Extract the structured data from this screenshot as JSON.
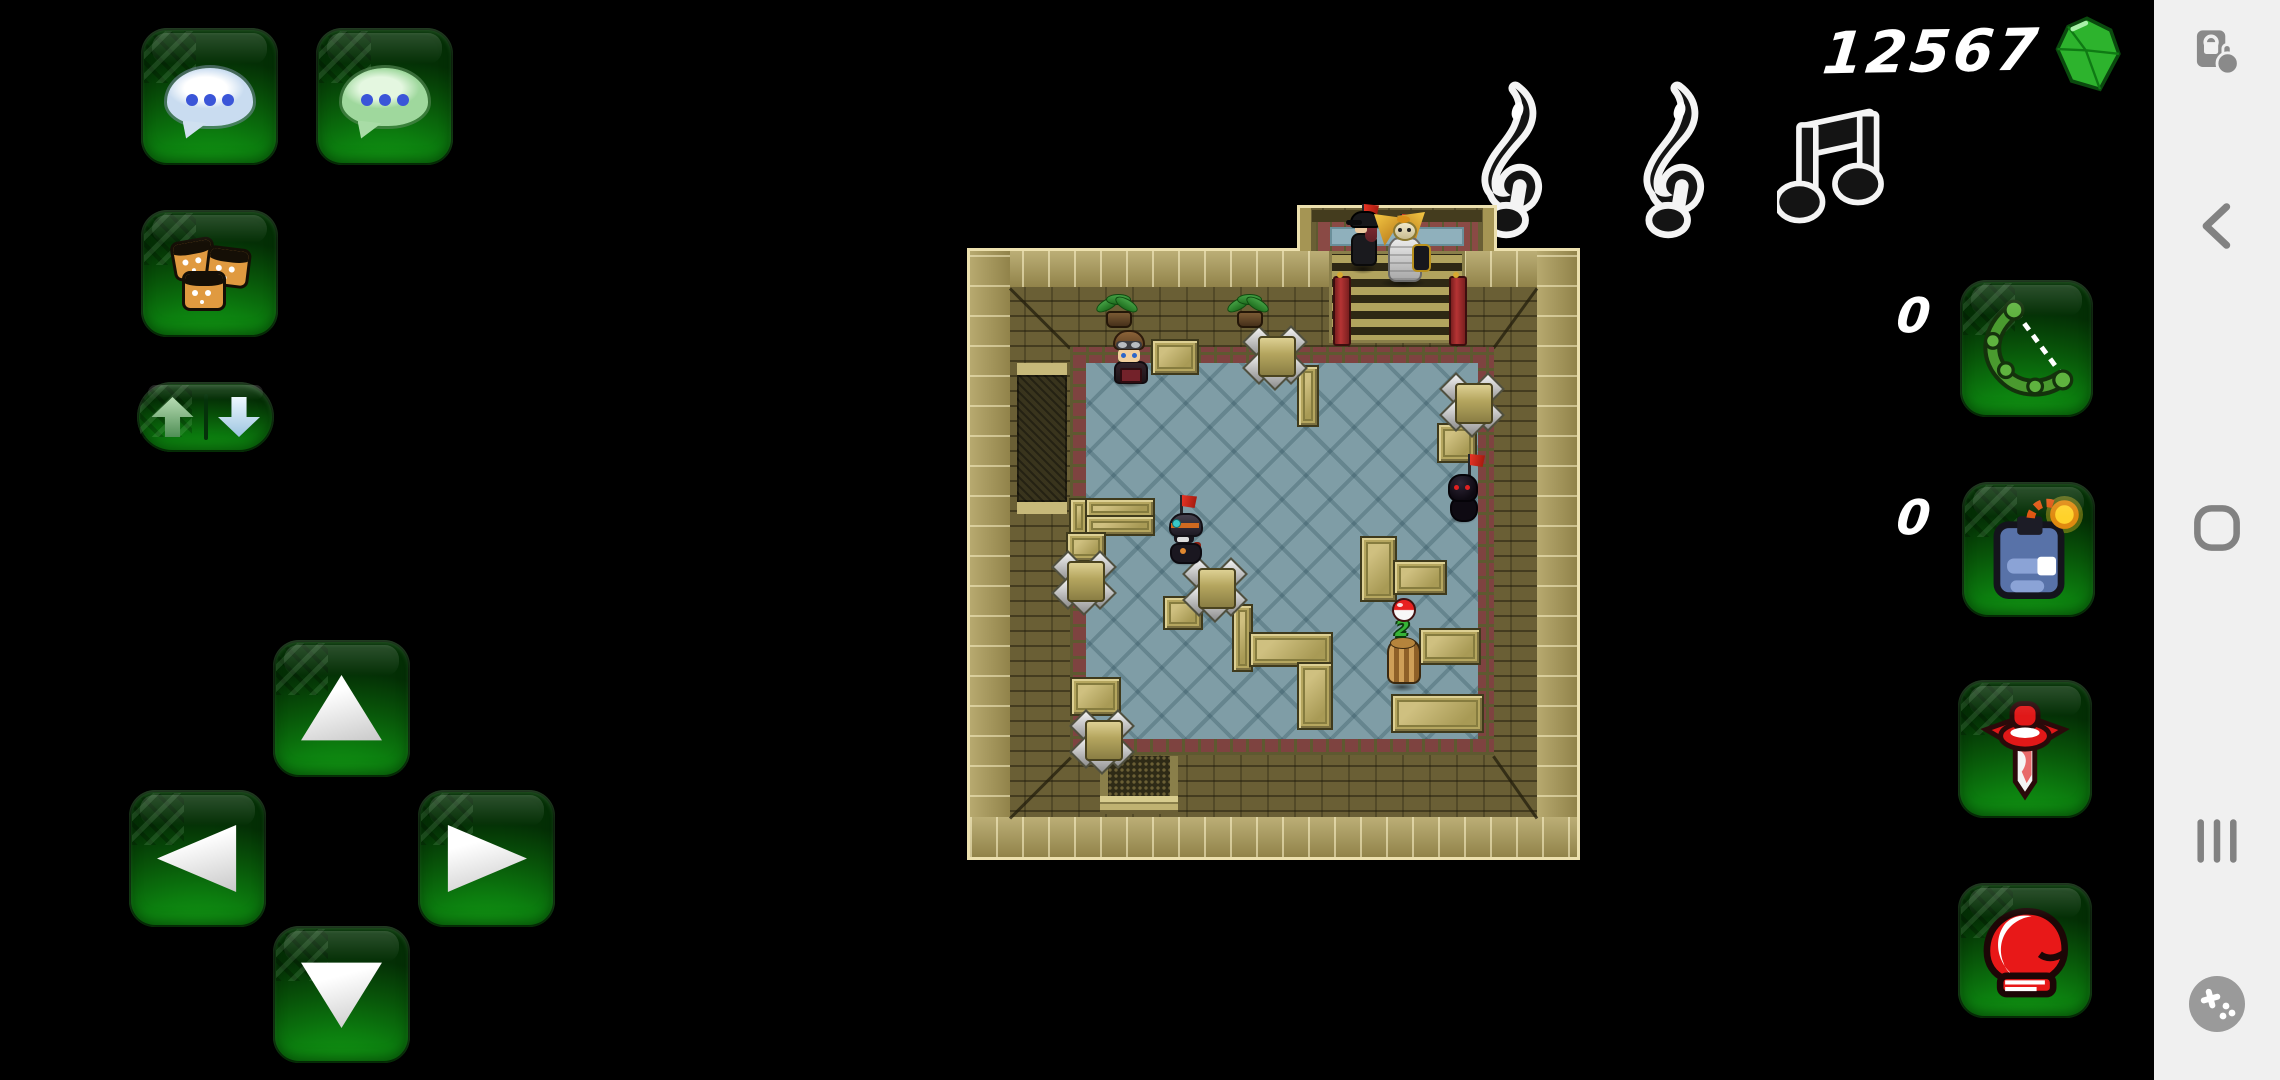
{
  "hud": {
    "score": "12567",
    "gem_icon": "green-gem",
    "music_indicators": [
      "treble-clef",
      "treble-clef",
      "eighth-notes"
    ]
  },
  "left_controls": {
    "chat_button_icon": "white-chat-bubble",
    "guild_chat_button_icon": "green-chat-bubble",
    "emotes_button_icon": "player-faces",
    "swap_button_icons": {
      "left": "arrow-up-green",
      "right": "arrow-down-white"
    }
  },
  "dpad": {
    "buttons": [
      "up",
      "left",
      "right",
      "down"
    ]
  },
  "items": {
    "bow": {
      "count": "0",
      "icon": "green-bow"
    },
    "bomb": {
      "count": "0",
      "icon": "blue-bomb"
    },
    "potion": {
      "icon": "red-vial"
    },
    "glove": {
      "icon": "red-boxing-glove"
    }
  },
  "nav_bar": {
    "icons": [
      "screen-pin",
      "back-chevron",
      "home-squircle",
      "recents-bars",
      "game-booster-pad"
    ]
  },
  "palette": {
    "button_green": "#0c7e0f",
    "nav_gray": "#f0f0f0",
    "icon_gray": "#828282",
    "score_white": "#ffffff",
    "gem_green": "#2db32d",
    "wall_olive": "#6a5f35",
    "wall_light": "#a59554",
    "floor_blue": "#7f9da6",
    "border_maroon": "#7e4340",
    "crate_tan": "#b5a65f",
    "flag_red": "#d92f20"
  },
  "game_map": {
    "player_badge": "2",
    "entities": {
      "plants": [
        [
          131,
          94
        ],
        [
          262,
          94
        ]
      ],
      "spikes": [
        [
          285,
          133
        ],
        [
          482,
          180
        ],
        [
          94,
          358
        ],
        [
          225,
          365
        ],
        [
          112,
          517
        ]
      ],
      "crates": [
        [
          184,
          139,
          44,
          32
        ],
        [
          330,
          165,
          18,
          58
        ],
        [
          470,
          223,
          36,
          36
        ],
        [
          102,
          298,
          16,
          34
        ],
        [
          118,
          298,
          66,
          17
        ],
        [
          118,
          315,
          66,
          17
        ],
        [
          99,
          332,
          36,
          26
        ],
        [
          196,
          396,
          36,
          30
        ],
        [
          265,
          404,
          17,
          64
        ],
        [
          282,
          432,
          80,
          31
        ],
        [
          330,
          462,
          32,
          64
        ],
        [
          393,
          336,
          33,
          62
        ],
        [
          426,
          360,
          50,
          31
        ],
        [
          452,
          428,
          58,
          33
        ],
        [
          424,
          494,
          89,
          35
        ],
        [
          103,
          477,
          47,
          35
        ]
      ],
      "flags": [
        [
          204,
          295
        ],
        [
          492,
          254
        ],
        [
          386,
          4
        ],
        [
          424,
          14
        ]
      ],
      "characters": [
        {
          "type": "aviator",
          "x": 145,
          "y": 130
        },
        {
          "type": "ninja_masked",
          "x": 200,
          "y": 312
        },
        {
          "type": "ninja_dark",
          "x": 479,
          "y": 272
        },
        {
          "type": "mummy",
          "x": 417,
          "y": 398
        },
        {
          "type": "capgirl",
          "x": 381,
          "y": 8
        },
        {
          "type": "winged",
          "x": 410,
          "y": 12
        }
      ]
    }
  }
}
